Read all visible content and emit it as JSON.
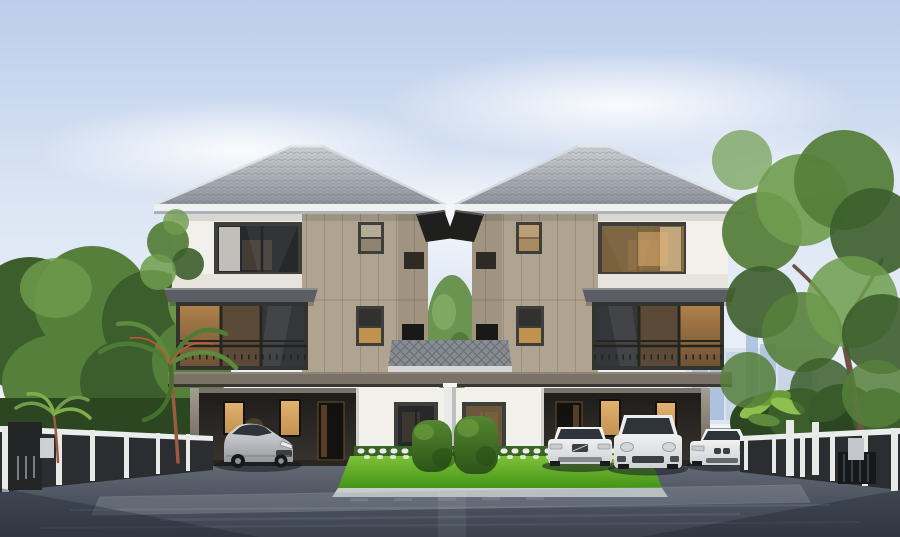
{
  "scene": {
    "type": "architectural-rendering",
    "subject": "Twin three-story duplex houses with ground-floor carports, front lawn, perimeter fences, city skyline and trees",
    "houses": [
      {
        "id": "house-left",
        "floors": 3,
        "roof": "gray hip roof",
        "interior_lights_on": true
      },
      {
        "id": "house-right",
        "floors": 3,
        "roof": "gray hip roof",
        "interior_lights_on": true
      }
    ],
    "vehicles": [
      {
        "name": "silver-sports-coupe",
        "location": "left-carport"
      },
      {
        "name": "white-sedan",
        "location": "right-carport"
      },
      {
        "name": "white-suv",
        "location": "right-carport"
      },
      {
        "name": "white-roadster",
        "location": "right-driveway"
      }
    ],
    "landscape": {
      "foreground": "dark asphalt driveway with reflections",
      "center": "green lawn with white flowers, two trimmed hedges, white divider post",
      "left": "dark fence with white posts, palm trees, tall blue tower",
      "right": "dark fence with white gate posts, large tree, hazy city skyline"
    },
    "palette": {
      "sky_top": "#bccdeb",
      "sky_mid": "#dce6f4",
      "sky_low": "#f3f6fa",
      "cloud": "#ffffff",
      "city_main": "#9fb6d6",
      "city_haze": "#c6d3e5",
      "tree_green": "#567f3b",
      "tree_light": "#6f9c4e",
      "tree_dark": "#3c5e2c",
      "tree_deep": "#2b4620",
      "palm_trunk": "#a05a3c",
      "roof_light": "#cdd1d7",
      "roof_mid": "#8d929b",
      "roof_dark": "#62666d",
      "fascia": "#eef0f2",
      "wall_white": "#f2f0ea",
      "wall_sill": "#e7e4dd",
      "taupe": "#b0a491",
      "taupe_dark": "#978b79",
      "trim_dark": "#3e3e3b",
      "fin_black": "#1f1f1d",
      "glass_dark": "#26282c",
      "lit_warm": "#c1924f",
      "lit_bright": "#e3b26f",
      "awning": "#5d5e63",
      "divider": "#7b7267",
      "carport": "#242220",
      "pent_tile": "#878b92",
      "post_white": "#e9eae8",
      "lawn_light": "#7ec13a",
      "lawn_dark": "#459417",
      "hedge": "#54862f",
      "hedge_dark": "#2c5419",
      "flower": "#f4f6ef",
      "bed_green": "#3a6326",
      "curb": "#c9cecb",
      "ground_top": "#8d929b",
      "road_mid": "#4d5461",
      "road_deep": "#3b414d",
      "streak": "#aab3c0",
      "fence_dark": "#2b2d30",
      "fence_white": "#eceeed",
      "car_silver": "#c9cacd",
      "car_white": "#eff0f0",
      "car_glass": "#2f333a",
      "car_detail": "#3c3e42",
      "shadow": "#141820"
    }
  }
}
